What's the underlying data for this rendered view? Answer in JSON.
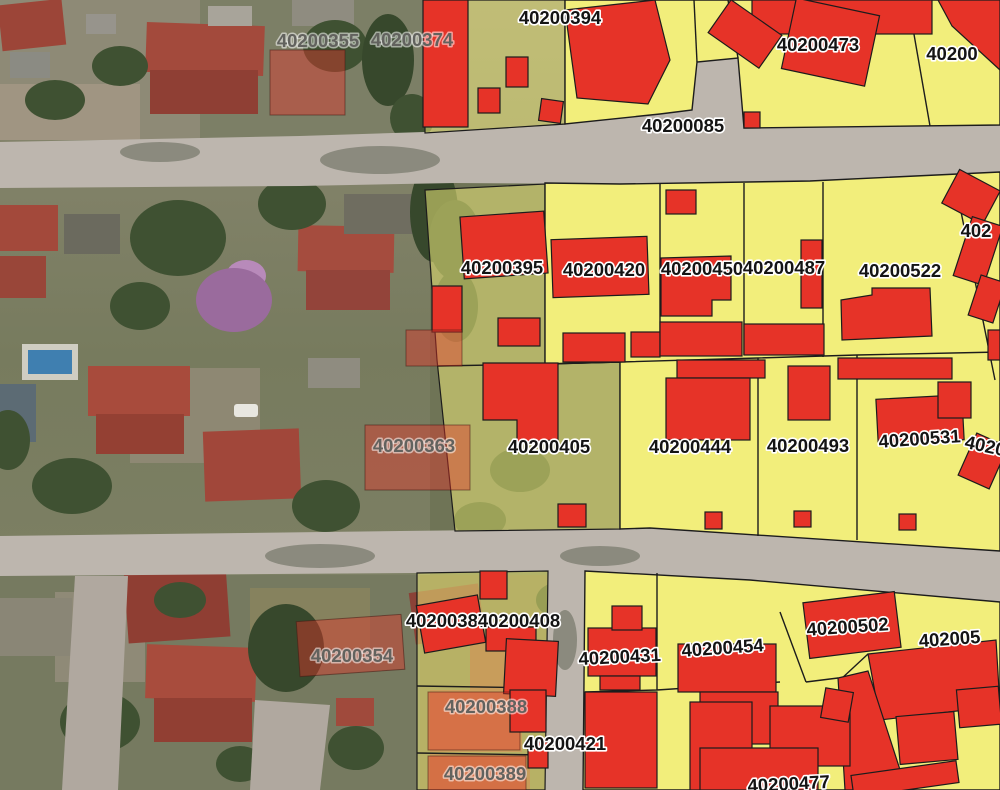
{
  "map": {
    "type": "cadastral-parcel-overlay-on-aerial-imagery",
    "colors": {
      "parcel_yellow": "#f2ee7b",
      "building_red": "#e63328",
      "road_gray": "#bdb6ae",
      "boundary": "#1c1c1c",
      "label_black": "#141414",
      "label_gray": "#62625e",
      "halo": "#ffffff"
    },
    "labels": [
      {
        "text": "40200355",
        "x": 318,
        "y": 47,
        "style": "gray",
        "rot": 0
      },
      {
        "text": "40200374",
        "x": 412,
        "y": 46,
        "style": "gray",
        "rot": 0
      },
      {
        "text": "40200394",
        "x": 560,
        "y": 24,
        "style": "black",
        "rot": 0
      },
      {
        "text": "40200",
        "x": 952,
        "y": 60,
        "style": "black",
        "rot": 0,
        "anchor": "start"
      },
      {
        "text": "40200085",
        "x": 683,
        "y": 132,
        "style": "black",
        "rot": 0
      },
      {
        "text": "40200473",
        "x": 818,
        "y": 51,
        "style": "black",
        "rot": 0
      },
      {
        "text": "40200395",
        "x": 502,
        "y": 274,
        "style": "black",
        "rot": 0
      },
      {
        "text": "40200420",
        "x": 604,
        "y": 276,
        "style": "black",
        "rot": 0
      },
      {
        "text": "40200450",
        "x": 702,
        "y": 275,
        "style": "black",
        "rot": 0
      },
      {
        "text": "40200487",
        "x": 784,
        "y": 274,
        "style": "black",
        "rot": 0
      },
      {
        "text": "40200522",
        "x": 900,
        "y": 277,
        "style": "black",
        "rot": 0
      },
      {
        "text": "402",
        "x": 976,
        "y": 237,
        "style": "black",
        "rot": 0,
        "anchor": "start"
      },
      {
        "text": "40200363",
        "x": 414,
        "y": 452,
        "style": "gray",
        "rot": 0
      },
      {
        "text": "40200405",
        "x": 549,
        "y": 453,
        "style": "black",
        "rot": 0
      },
      {
        "text": "40200444",
        "x": 690,
        "y": 453,
        "style": "black",
        "rot": 0
      },
      {
        "text": "40200493",
        "x": 808,
        "y": 452,
        "style": "black",
        "rot": 0
      },
      {
        "text": "40200531",
        "x": 920,
        "y": 445,
        "style": "black",
        "rot": -4
      },
      {
        "text": "4020",
        "x": 984,
        "y": 452,
        "style": "black",
        "rot": 12,
        "anchor": "start"
      },
      {
        "text": "40200387",
        "x": 447,
        "y": 627,
        "style": "black",
        "rot": 0
      },
      {
        "text": "40200408",
        "x": 519,
        "y": 627,
        "style": "black",
        "rot": 0
      },
      {
        "text": "40200354",
        "x": 352,
        "y": 662,
        "style": "gray",
        "rot": 0
      },
      {
        "text": "40200431",
        "x": 620,
        "y": 663,
        "style": "black",
        "rot": -3
      },
      {
        "text": "40200454",
        "x": 723,
        "y": 654,
        "style": "black",
        "rot": -4
      },
      {
        "text": "40200502",
        "x": 848,
        "y": 633,
        "style": "black",
        "rot": -4
      },
      {
        "text": "402005",
        "x": 950,
        "y": 645,
        "style": "black",
        "rot": -4,
        "anchor": "start"
      },
      {
        "text": "40200388",
        "x": 486,
        "y": 713,
        "style": "gray",
        "rot": 0
      },
      {
        "text": "40200421",
        "x": 565,
        "y": 750,
        "style": "black",
        "rot": 0
      },
      {
        "text": "40200389",
        "x": 485,
        "y": 780,
        "style": "gray",
        "rot": 0
      },
      {
        "text": "40200477",
        "x": 789,
        "y": 790,
        "style": "black",
        "rot": -3
      }
    ]
  }
}
